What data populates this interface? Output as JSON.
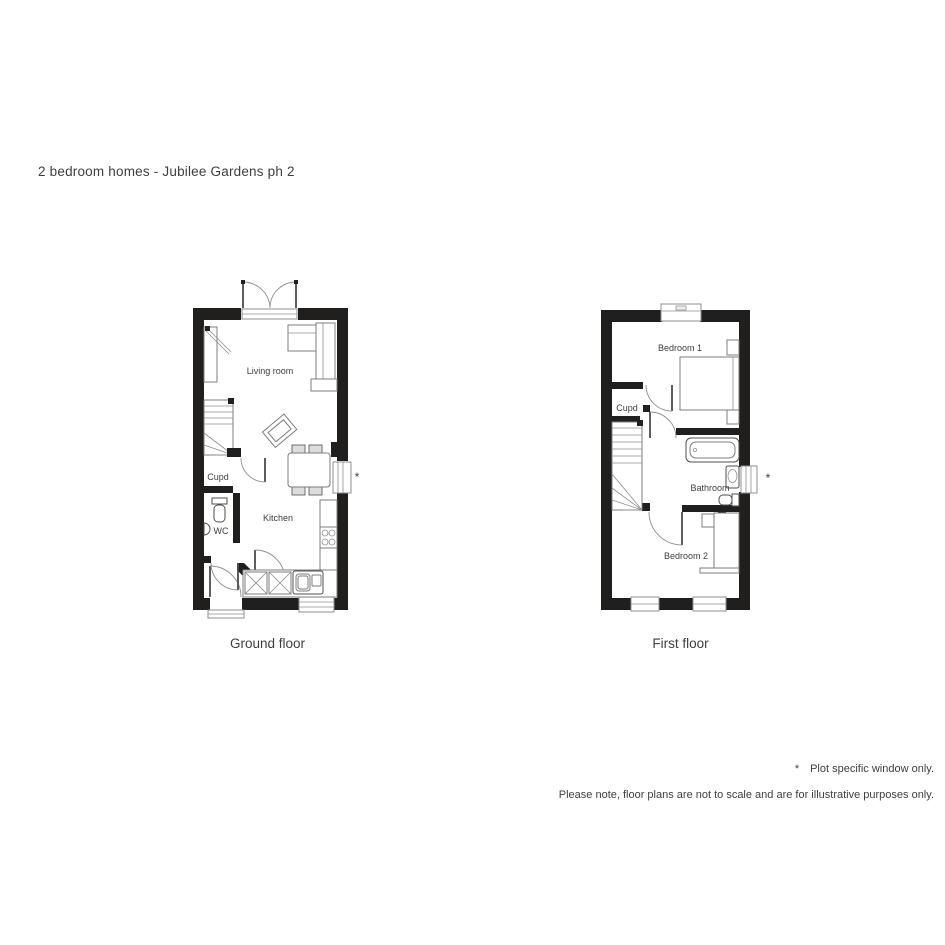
{
  "title": "2 bedroom homes - Jubilee Gardens ph 2",
  "ground_floor": {
    "caption": "Ground floor",
    "labels": {
      "living_room": "Living room",
      "kitchen": "Kitchen",
      "cupboard": "Cupd",
      "wc": "WC"
    },
    "window_marker": "*"
  },
  "first_floor": {
    "caption": "First floor",
    "labels": {
      "bedroom1": "Bedroom 1",
      "bedroom2": "Bedroom 2",
      "bathroom": "Bathroom",
      "cupboard": "Cupd"
    },
    "window_marker": "*"
  },
  "footnotes": {
    "marker": "*",
    "line1": "Plot specific window only.",
    "line2": "Please note, floor plans are not to scale and are for illustrative purposes only."
  },
  "colors": {
    "wall": "#201f1d",
    "furniture_line": "#7d7d7d",
    "text": "#3f3f3f"
  }
}
